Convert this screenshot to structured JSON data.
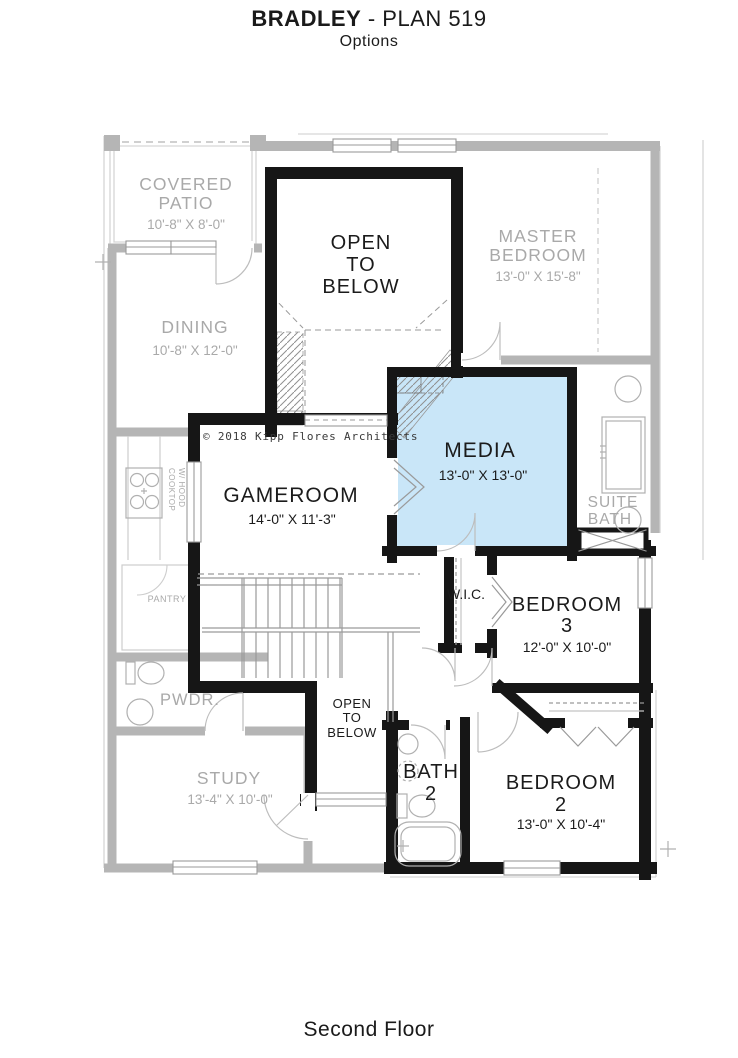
{
  "header": {
    "title_bold": "BRADLEY",
    "title_rest": " - PLAN 519",
    "subtitle": "Options"
  },
  "footer": {
    "label": "Second Floor"
  },
  "plan": {
    "copyright": "© 2018 Kipp Flores Architects",
    "highlight_color": "#c9e6f8",
    "rooms": {
      "covered_patio": {
        "lines": [
          "COVERED",
          "PATIO"
        ],
        "dims": "10'-8\" X 8'-0\""
      },
      "dining": {
        "name": "DINING",
        "dims": "10'-8\" X 12'-0\""
      },
      "master_bedroom": {
        "lines": [
          "MASTER",
          "BEDROOM"
        ],
        "dims": "13'-0\" X 15'-8\""
      },
      "open_to_below_upper": {
        "lines": [
          "OPEN",
          "TO",
          "BELOW"
        ]
      },
      "media": {
        "name": "MEDIA",
        "dims": "13'-0\" X 13'-0\""
      },
      "gameroom": {
        "name": "GAMEROOM",
        "dims": "14'-0\" X 11'-3\""
      },
      "suite_bath": {
        "lines": [
          "SUITE",
          "BATH"
        ]
      },
      "wic": {
        "name": "W.I.C."
      },
      "bedroom3": {
        "lines": [
          "BEDROOM",
          "3"
        ],
        "dims": "12'-0\" X 10'-0\""
      },
      "pantry": {
        "name": "PANTRY"
      },
      "powder": {
        "name": "PWDR."
      },
      "cooktop": {
        "lines": [
          "COOKTOP",
          "W/ HOOD"
        ]
      },
      "open_to_below_lower": {
        "lines": [
          "OPEN",
          "TO",
          "BELOW"
        ]
      },
      "study": {
        "name": "STUDY",
        "dims": "13'-4\" X 10'-0\""
      },
      "bath2": {
        "lines": [
          "BATH",
          "2"
        ]
      },
      "bedroom2": {
        "lines": [
          "BEDROOM",
          "2"
        ],
        "dims": "13'-0\" X 10'-4\""
      }
    }
  }
}
